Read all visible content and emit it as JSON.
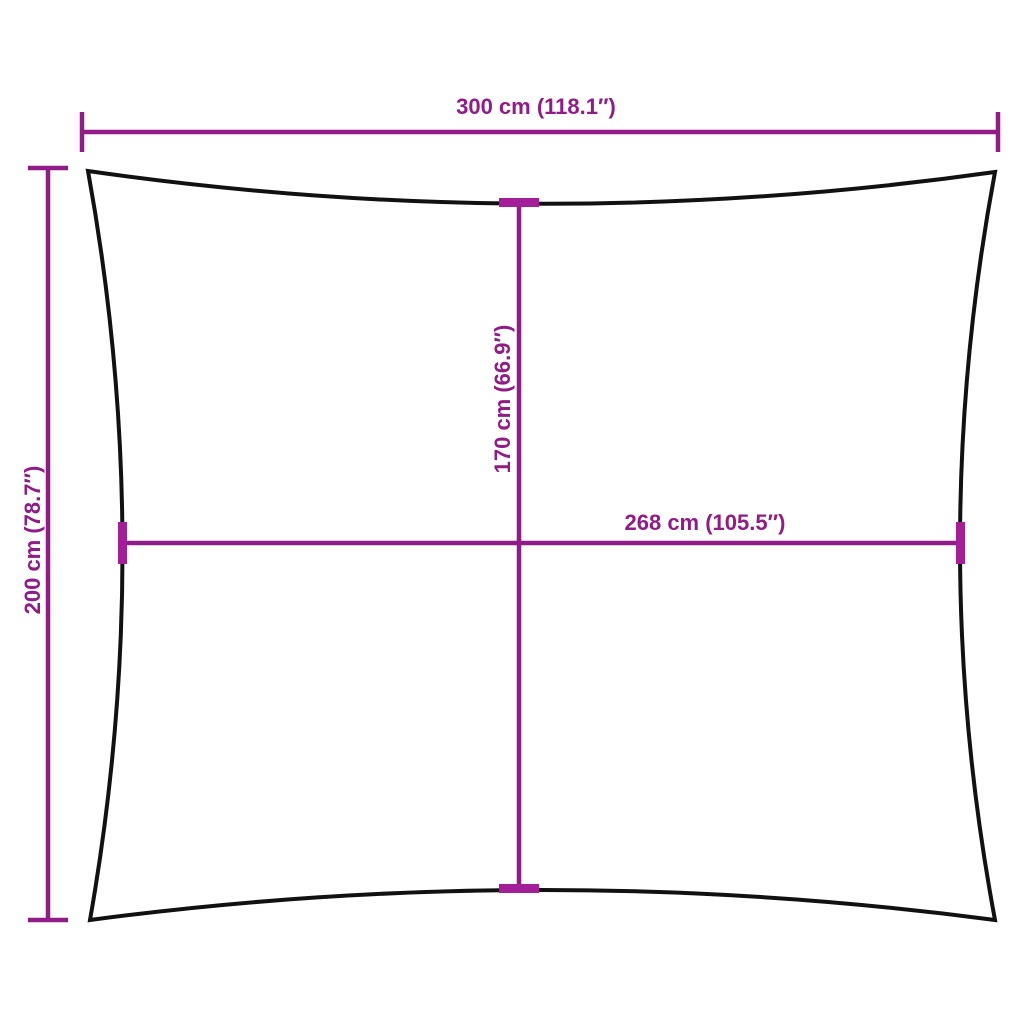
{
  "page": {
    "background": "#ffffff",
    "description": "Product dimension diagram of a rectangular shade sail with concave edges"
  },
  "diagram": {
    "type": "product-dimension-diagram",
    "subject": "rectangular-shade-sail-outline",
    "colors": {
      "dimension_accent": "#911b87",
      "tick_accent": "#a21f98",
      "outline": "#111111",
      "background": "#ffffff"
    },
    "dimensions": {
      "overall_width": {
        "label": "300 cm (118.1″)",
        "cm": 300,
        "inches": 118.1,
        "orientation": "horizontal",
        "position": "top-outside"
      },
      "overall_height": {
        "label": "200 cm (78.7″)",
        "cm": 200,
        "inches": 78.7,
        "orientation": "vertical",
        "position": "left-outside"
      },
      "inner_height": {
        "label": "170 cm (66.9″)",
        "cm": 170,
        "inches": 66.9,
        "orientation": "vertical",
        "position": "center"
      },
      "inner_width": {
        "label": "268 cm (105.5″)",
        "cm": 268,
        "inches": 105.5,
        "orientation": "horizontal",
        "position": "center"
      }
    }
  }
}
